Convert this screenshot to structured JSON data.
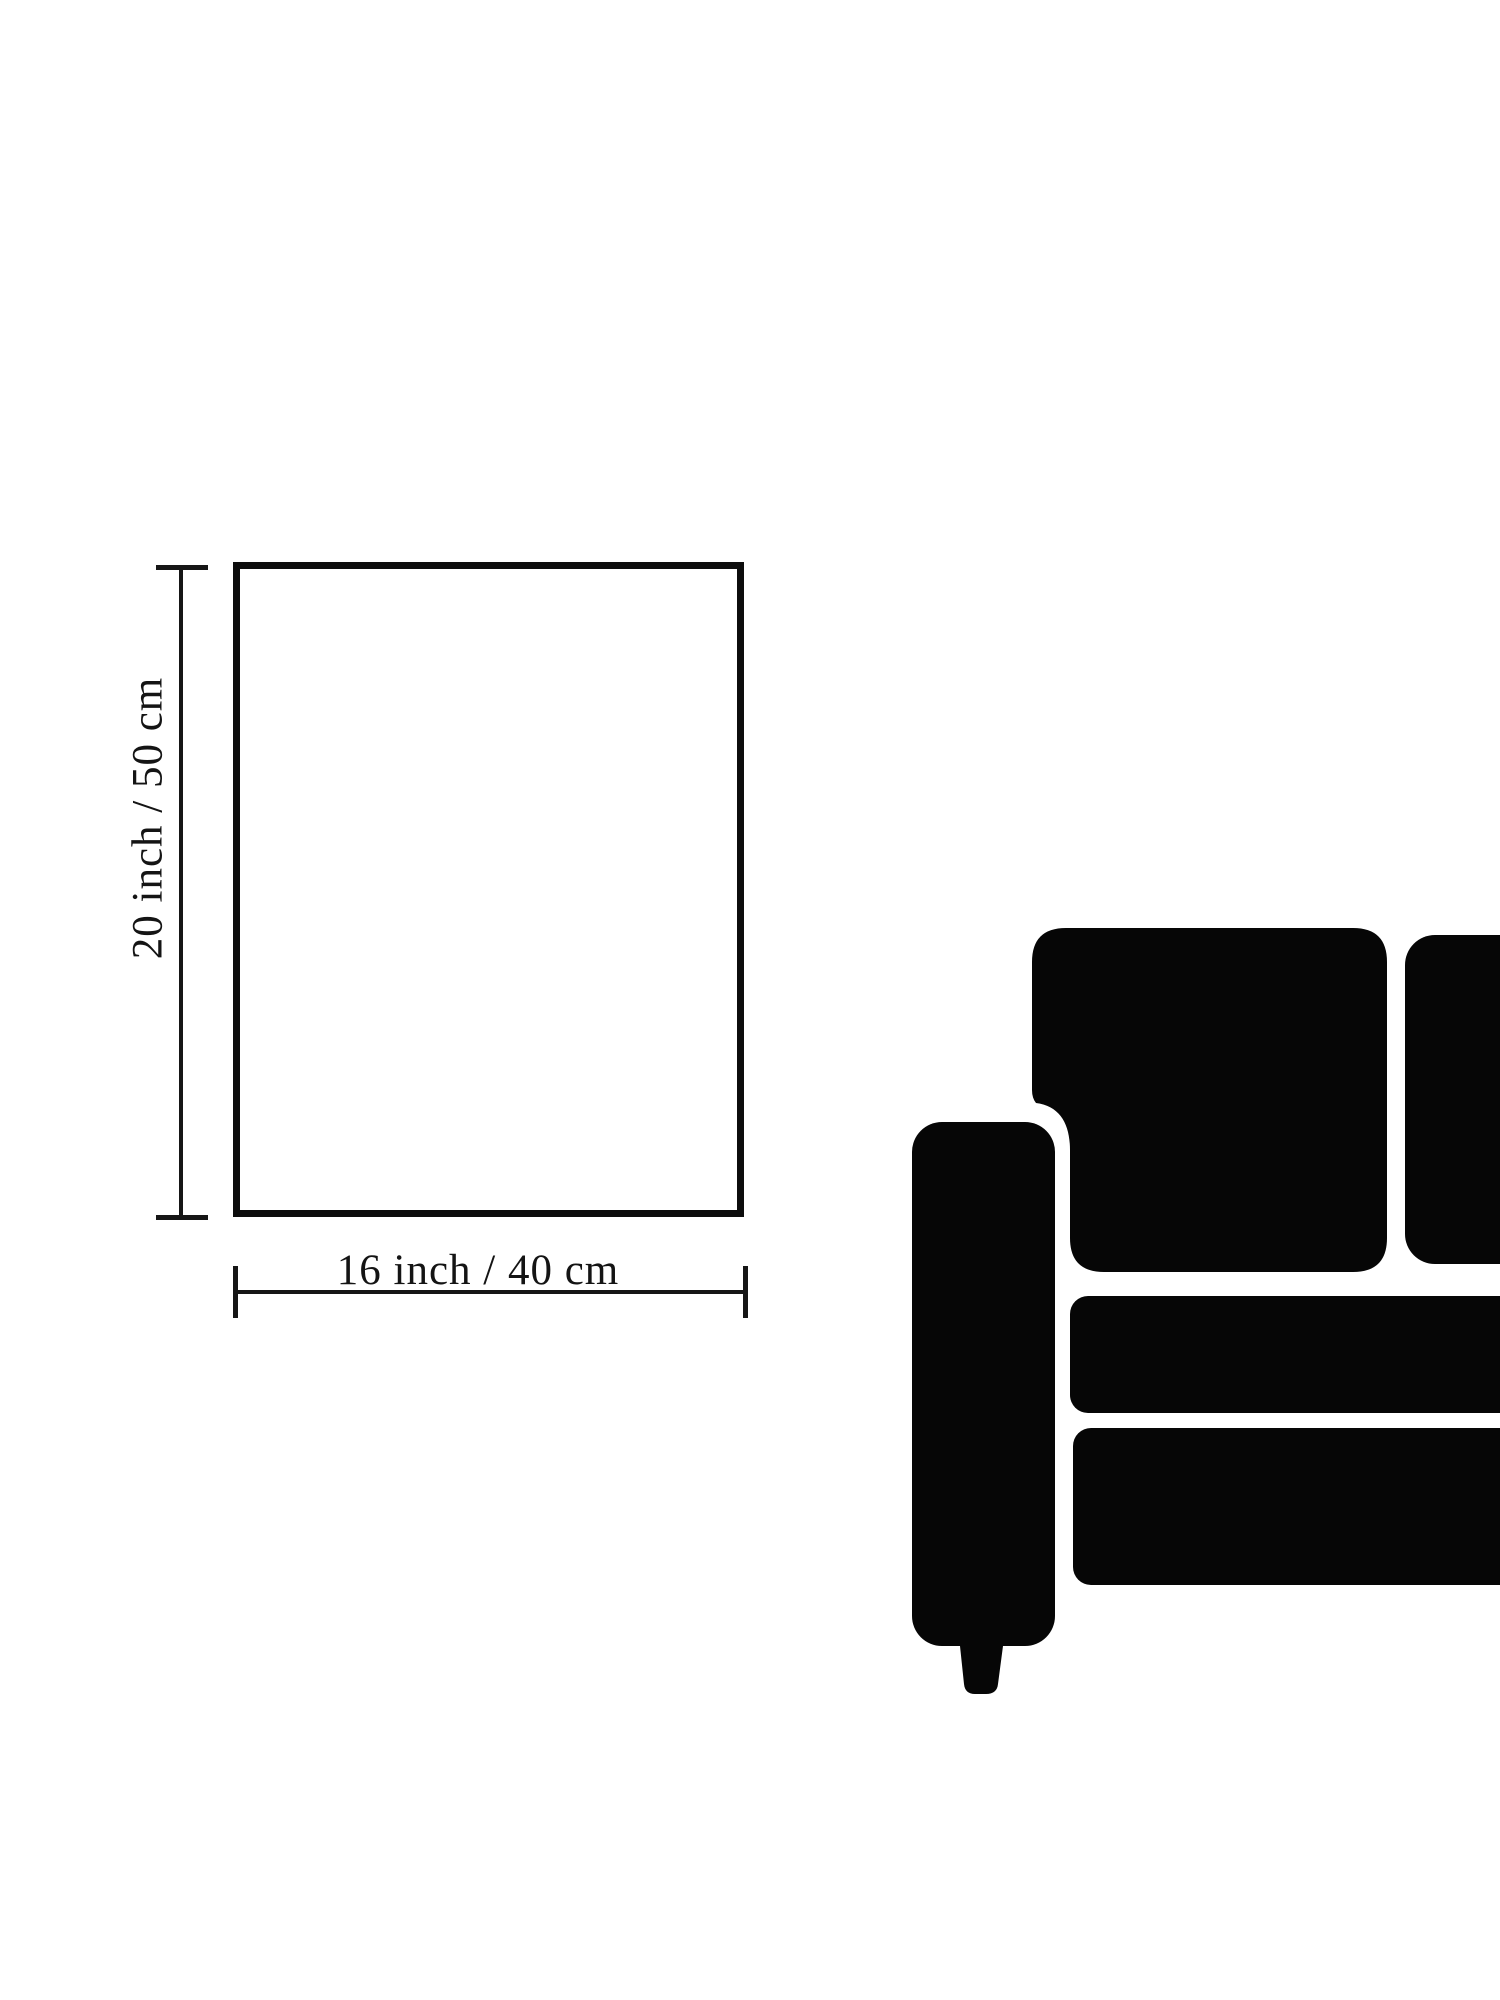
{
  "image": {
    "background_color": "#ffffff",
    "line_color": "#141414",
    "sofa_color": "#060606"
  },
  "dimension_diagram": {
    "height_label": "20 inch / 50 cm",
    "width_label": "16 inch / 40 cm"
  },
  "sofa": {
    "description": "black loveseat silhouette cropped at right edge",
    "parts": [
      "armrest",
      "foot",
      "back-cushion-left",
      "back-cushion-right",
      "seat-cushion-top",
      "seat-cushion-bottom"
    ]
  }
}
